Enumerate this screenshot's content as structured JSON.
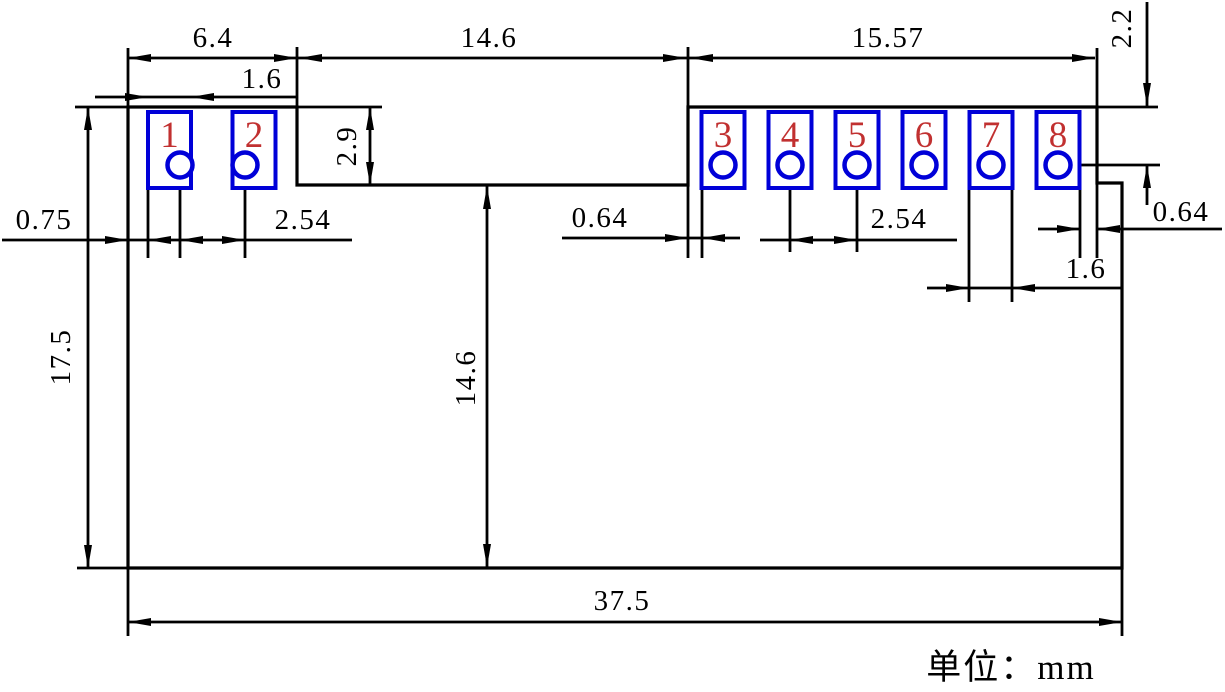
{
  "drawing": {
    "title": "connector-footprint-dimension-drawing",
    "unit_label": "单位：mm",
    "pads": [
      {
        "number": "1"
      },
      {
        "number": "2"
      },
      {
        "number": "3"
      },
      {
        "number": "4"
      },
      {
        "number": "5"
      },
      {
        "number": "6"
      },
      {
        "number": "7"
      },
      {
        "number": "8"
      }
    ],
    "dims": {
      "left_module_width": "6.4",
      "middle_gap_width": "14.6",
      "right_module_width": "15.57",
      "pad_row_top_offset": "2.2",
      "pad1_width": "1.6",
      "notch_depth": "2.9",
      "edge_to_pad1": "0.75",
      "left_pitch": "2.54",
      "edge_to_pad3": "0.64",
      "right_pitch": "2.54",
      "pad8_to_edge": "0.64",
      "pad7_width": "1.6",
      "overall_height": "17.5",
      "lower_body_height": "14.6",
      "overall_width": "37.5"
    },
    "colors": {
      "line": "#000000",
      "pad_outline": "#0000d8",
      "pad_number": "#c13030",
      "background": "#ffffff"
    }
  }
}
